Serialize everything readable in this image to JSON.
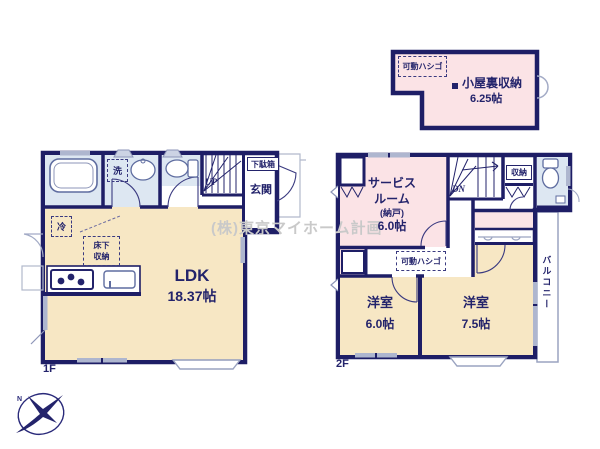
{
  "watermark": "(株)東京マイホーム計画",
  "logo": {
    "n": "N"
  },
  "attic": {
    "ladder": "可動ハシゴ",
    "name": "小屋裏収納",
    "size": "6.25帖"
  },
  "floor1": {
    "label": "1F",
    "wash": "洗",
    "shoe_box": "下駄箱",
    "entrance": "玄関",
    "stairs_up": "UP",
    "fridge": "冷",
    "underfloor_line1": "床下",
    "underfloor_line2": "収納",
    "ldk": "LDK",
    "ldk_size": "18.37帖"
  },
  "floor2": {
    "label": "2F",
    "service_line1": "サービス",
    "service_line2": "ルーム",
    "service_line3": "(納戸)",
    "service_size": "6.0帖",
    "stairs_down": "DN",
    "closet": "収納",
    "ladder": "可動ハシゴ",
    "west_room": "洋室",
    "west_room_size": "6.0帖",
    "east_room": "洋室",
    "east_room_size": "7.5帖",
    "balcony": "バルコニー"
  }
}
